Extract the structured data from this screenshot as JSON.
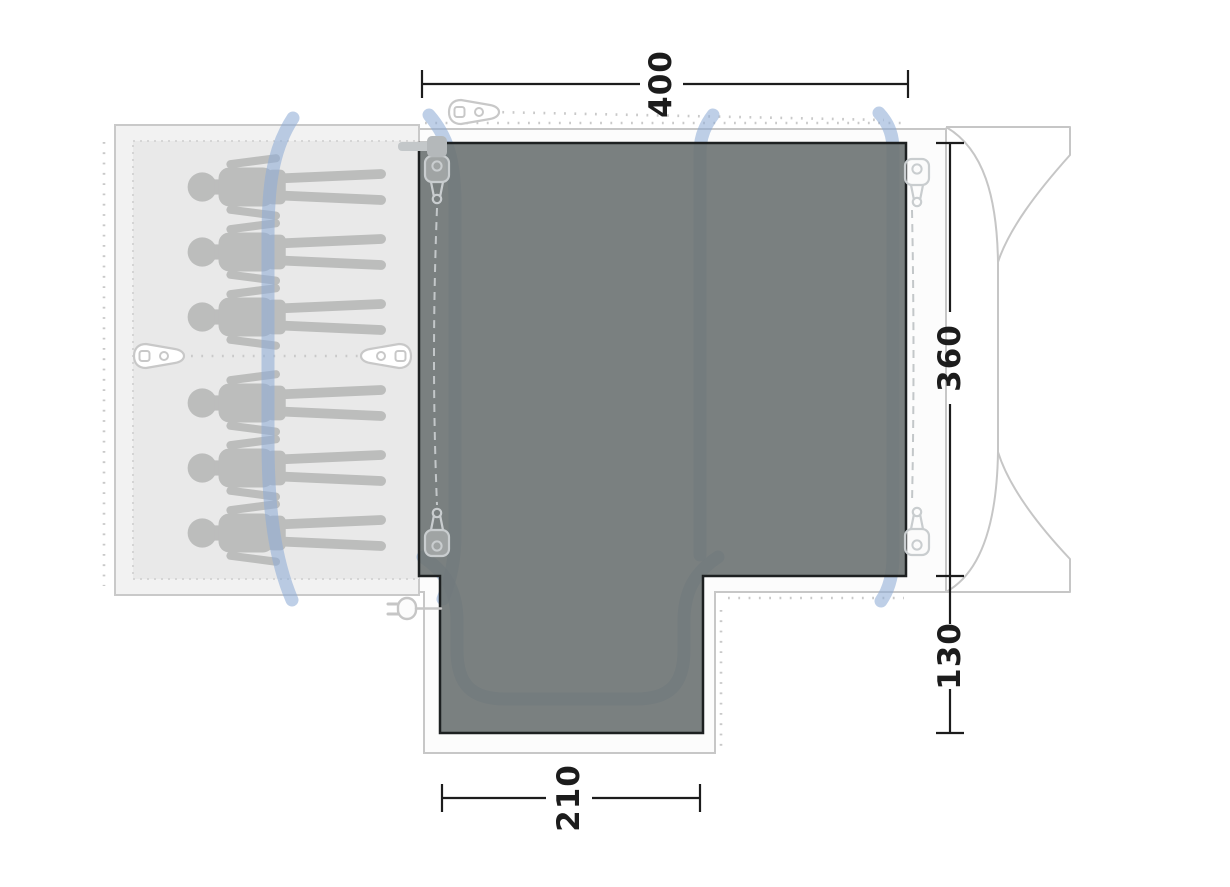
{
  "diagram": {
    "kind": "tent-awning-floorplan-top-view",
    "dimensions": {
      "width_top": "400",
      "depth_right": "360",
      "connection_depth_right": "130",
      "porch_width_bottom": "210"
    },
    "sleeping_area": {
      "person_count": 6,
      "rows": "3 + 3 head-to-left"
    },
    "icons": [
      "tent-peg-icon",
      "zipper-pull-icon",
      "power-plug-icon",
      "cable-entry-icon",
      "person-silhouette",
      "vehicle-outline"
    ],
    "colors": {
      "floor_dark": "#848989",
      "floor_outline": "#1d2021",
      "pole_blue": "#a9bedd",
      "light_outline": "#c7c7c7",
      "cabin_fill": "#e9e9e9",
      "silhouette": "#b8b9b8",
      "dimension": "#1c1c1c"
    }
  }
}
